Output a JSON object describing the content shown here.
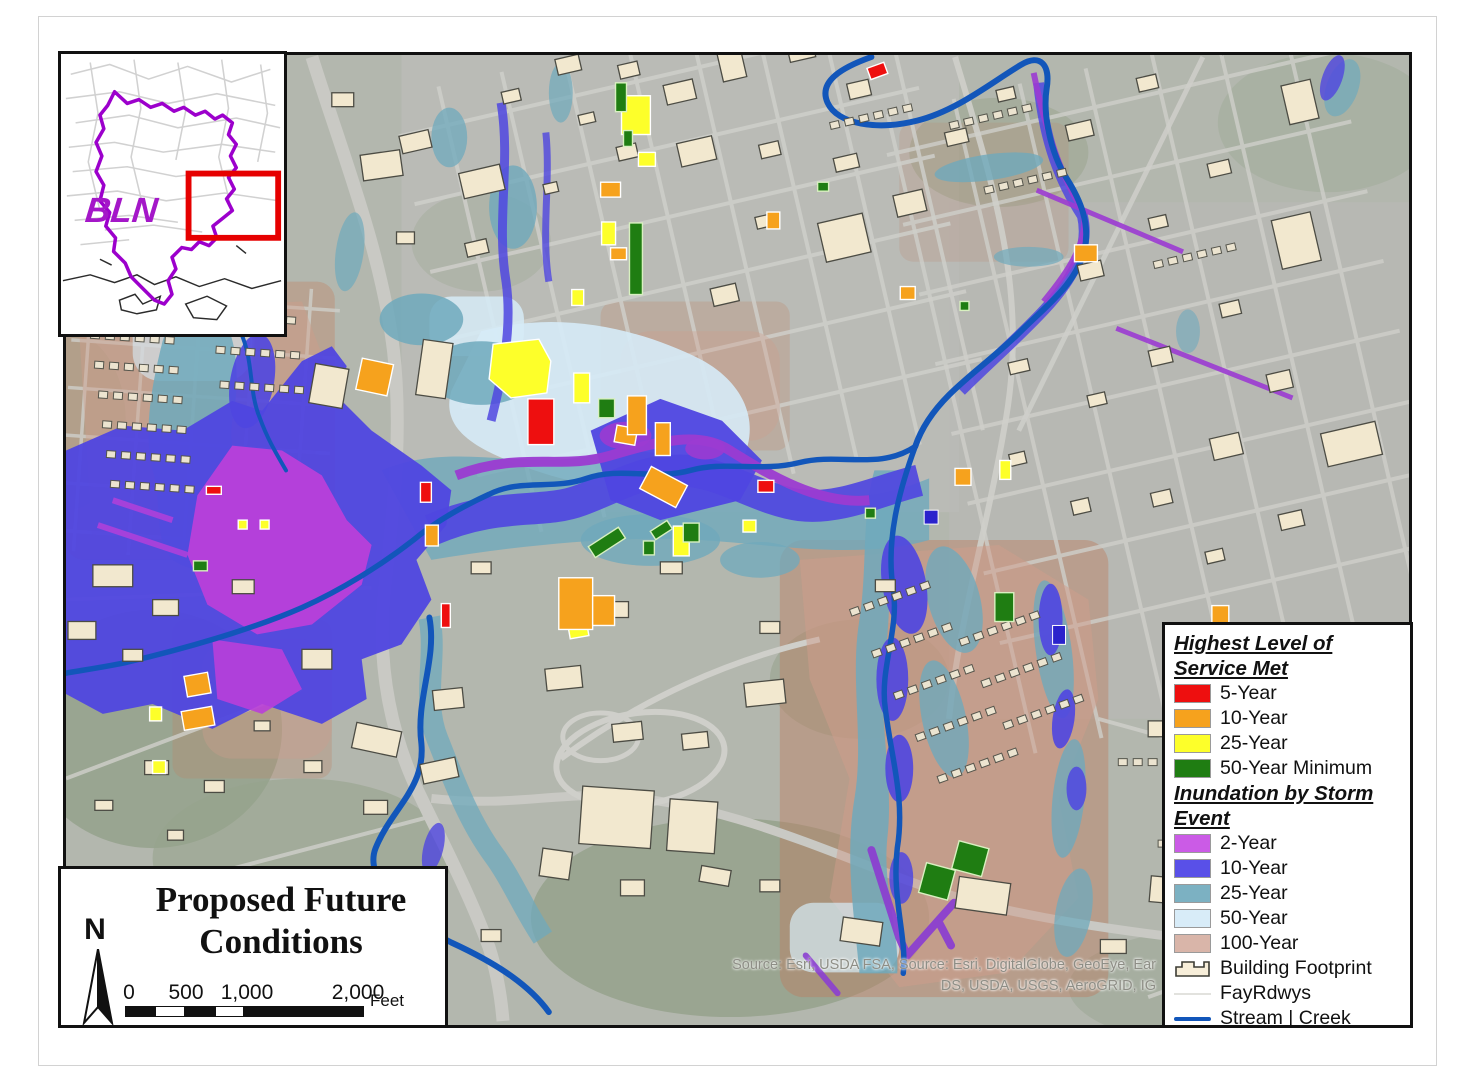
{
  "inset": {
    "watershed_label": "BLN",
    "label_color": "#a417c8",
    "boundary_color": "#9c00cc",
    "highlight_box_color": "#e60000"
  },
  "title_box": {
    "title_line1": "Proposed Future",
    "title_line2": "Conditions",
    "north_label": "N"
  },
  "scale_bar": {
    "ticks": [
      "0",
      "500",
      "1,000",
      "2,000"
    ],
    "unit": "Feet"
  },
  "attribution": {
    "line1": "Source: Esri, USDA FSA,  Source: Esri, DigitalGlobe, GeoEye, Ear",
    "line2": "DS, USDA, USGS, AeroGRID, IG"
  },
  "legend": {
    "service": {
      "title": "Highest Level of Service Met",
      "items": [
        {
          "label": "5-Year",
          "color": "#ee0f0f"
        },
        {
          "label": "10-Year",
          "color": "#f6a21d"
        },
        {
          "label": "25-Year",
          "color": "#fdff2a"
        },
        {
          "label": "50-Year Minimum",
          "color": "#1f7d12"
        }
      ]
    },
    "storm": {
      "title": "Inundation by Storm Event",
      "items": [
        {
          "label": "2-Year",
          "color": "#cb5be6"
        },
        {
          "label": "10-Year",
          "color": "#5950e8"
        },
        {
          "label": "25-Year",
          "color": "#7cb1c2"
        },
        {
          "label": "50-Year",
          "color": "#d8ecf8"
        },
        {
          "label": "100-Year",
          "color": "#d9b5a9"
        }
      ]
    },
    "other": {
      "building_footprint": {
        "label": "Building Footprint",
        "fill": "#f7eed9",
        "outline": "#3c3c34"
      },
      "roads": {
        "label": "FayRdwys",
        "color": "#e2e2de"
      },
      "stream": {
        "label": "Stream | Creek",
        "color": "#1256ba"
      }
    }
  },
  "map_palette": {
    "stream": "#1256ba",
    "inundation_2yr": "#b93fd9",
    "inundation_10yr": "#4f46e0",
    "inundation_25yr": "#6fa9bc",
    "inundation_50yr": "#d6ebf7",
    "inundation_100yr": "#cf9d8b",
    "building": "#f2e8cf"
  }
}
